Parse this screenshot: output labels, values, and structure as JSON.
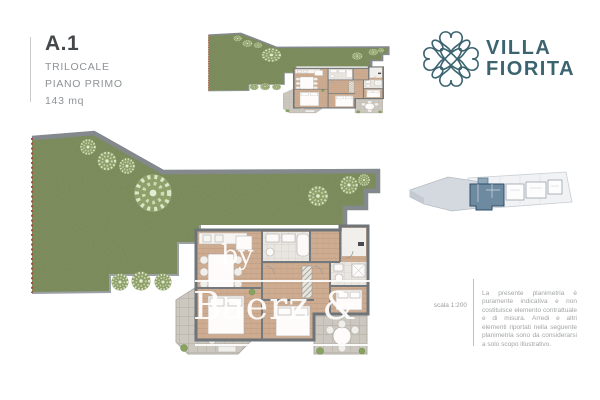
{
  "page": {
    "background": "#ffffff"
  },
  "unit_info": {
    "code": "A.1",
    "type": "TRILOCALE",
    "floor": "PIANO PRIMO",
    "area": "143 mq"
  },
  "brand": {
    "name_line1": "VILLA",
    "name_line2": "FIORITA",
    "color": "#3c6470",
    "icon": "flower-knot-icon"
  },
  "watermark": {
    "prefix": "by",
    "name": "Baerz & Co",
    "tagline": "LUXURY HOMES"
  },
  "disclaimer": {
    "scale_label": "scala 1:200",
    "text": "La presente planimetria è puramente indicativa e non costituisce elemento contrattuale e di misura. Arredi e altri elementi riportati nella seguente planimetria sono da considerarsi a solo scopo illustrativo."
  },
  "plan": {
    "garden_color": "#6f7f50",
    "wall_color": "#84898d",
    "boundary_color": "#a8402e",
    "terrace_color": "#ccc8c0",
    "floor_color": "#cdac91",
    "tile_color": "#e9e6e1"
  },
  "keyplan": {
    "slab_color": "#d3d9df",
    "unit_color": "#6d8aa1"
  }
}
